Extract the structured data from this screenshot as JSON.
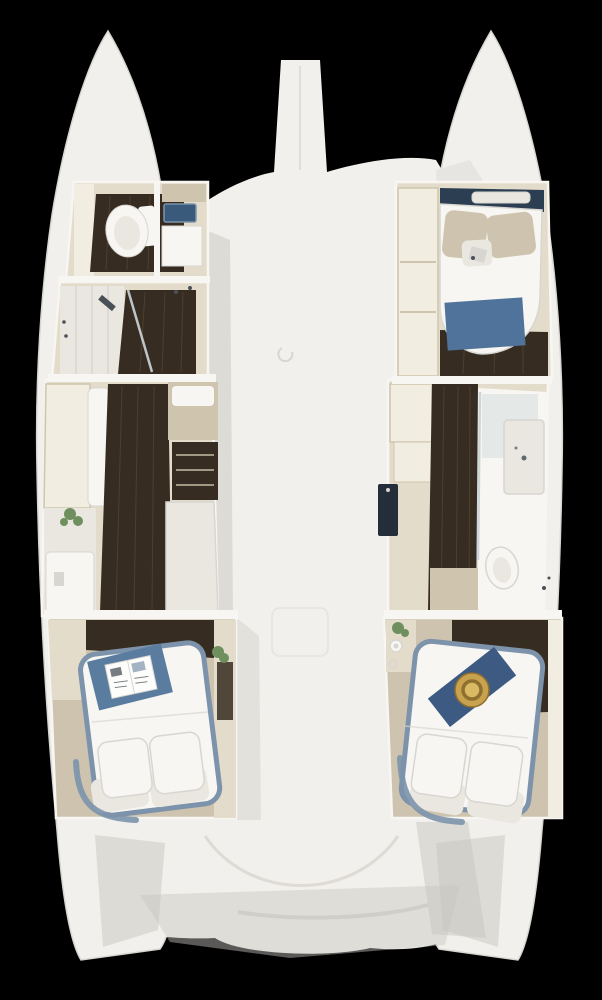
{
  "meta": {
    "description": "Top-down 3D cut-away floor plan render of a catamaran sailing yacht interior on a black background",
    "view": "overhead cutaway",
    "vessel_type": "catamaran"
  },
  "palette": {
    "background": "#000000",
    "hull": "#f2f0ec",
    "hull_edge": "#d8d6d1",
    "shadow": "#c7c5c0",
    "wall": "#e4dccb",
    "wall_light": "#f1ede1",
    "wall_dark": "#cfc5ae",
    "floor_dark": "#372c21",
    "floor_streak": "#54452f",
    "floor_tan": "#cdc3ae",
    "white_furniture": "#f7f6f3",
    "white_soft": "#eae7e0",
    "bed_frame": "#7c93ab",
    "navy_shelf": "#2c3e52",
    "navy_dark": "#232e3a",
    "blue_blanket": "#50739c",
    "blue_throw": "#5a7d9f",
    "blue_sink": "#3a5a7c",
    "runner_navy": "#3c5a82",
    "hat_gold": "#c9a24f",
    "hat_ring": "#8f6f2e",
    "hat_center": "#d9b964",
    "plant": "#6f8f5f",
    "glass": "#ccd6da",
    "paper": "#fdfdfc",
    "ink": "#4a5058"
  },
  "scene": {
    "deck_features": [
      "bowsprit",
      "foredeck",
      "anchor-locker-latch",
      "cockpit",
      "swim-platforms"
    ],
    "port_hull_rooms": [
      {
        "name": "bow head",
        "furniture": [
          "toilet",
          "blue sink",
          "vanity cabinet"
        ]
      },
      {
        "name": "shower room",
        "furniture": [
          "paneled doors",
          "glass shower",
          "wood floor"
        ]
      },
      {
        "name": "corridor wardrobe",
        "furniture": [
          "cabinets",
          "sofa",
          "desk",
          "plant",
          "bench"
        ]
      },
      {
        "name": "aft cabin",
        "furniture": [
          "double bed",
          "blue throw",
          "open magazine",
          "two pillows",
          "plant",
          "mirror"
        ]
      }
    ],
    "starboard_hull_rooms": [
      {
        "name": "forward cabin",
        "furniture": [
          "v-bed",
          "beige pillows",
          "blue blanket",
          "navy headboard shelf",
          "wardrobe"
        ]
      },
      {
        "name": "mid lockers",
        "furniture": [
          "cabinets",
          "navy locker"
        ]
      },
      {
        "name": "bathroom",
        "furniture": [
          "shower",
          "vanity sink",
          "toilet",
          "wood corridor"
        ]
      },
      {
        "name": "aft cabin",
        "furniture": [
          "double bed",
          "navy runner",
          "straw hat",
          "two pillows",
          "plant",
          "bottle",
          "dark wardrobe"
        ]
      }
    ]
  }
}
